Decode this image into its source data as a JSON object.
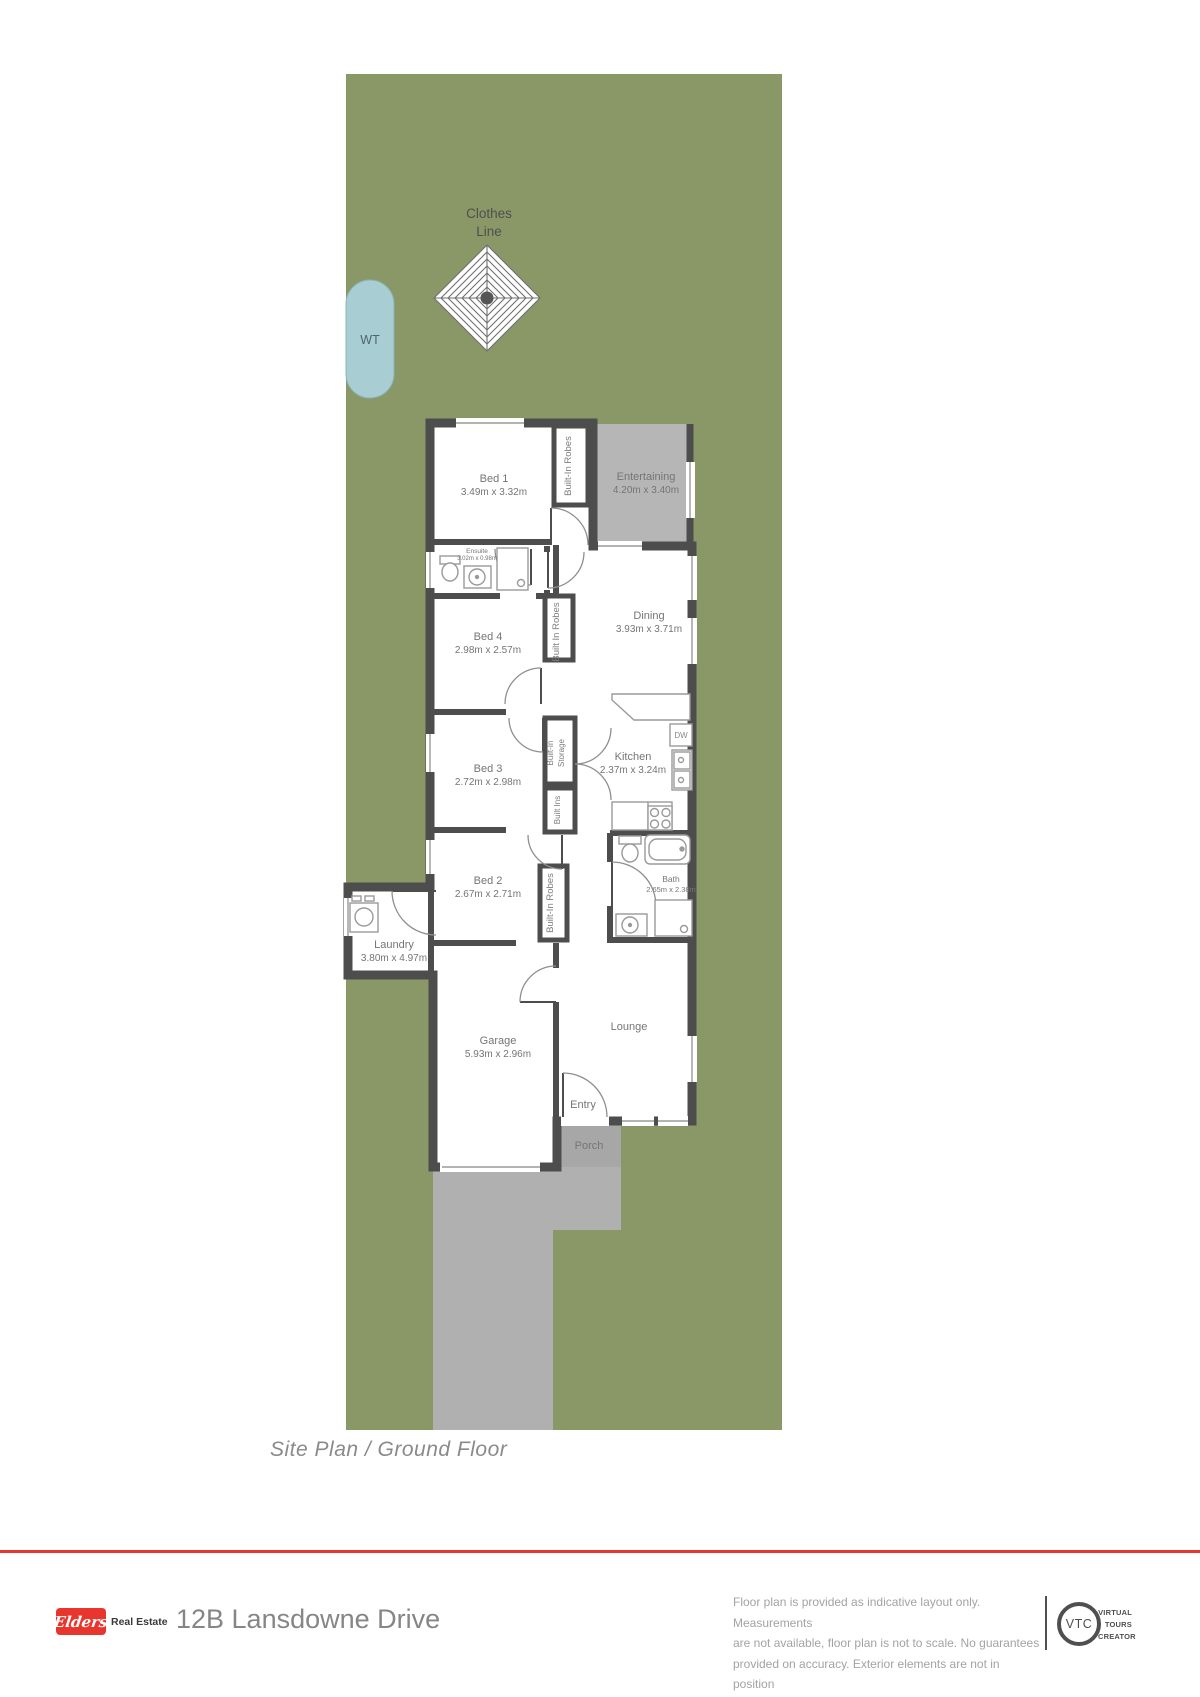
{
  "site": {
    "clothes_line_1": "Clothes",
    "clothes_line_2": "Line",
    "water_tank": "WT"
  },
  "rooms": {
    "bed1": {
      "name": "Bed 1",
      "dims": "3.49m x 3.32m"
    },
    "entertaining": {
      "name": "Entertaining",
      "dims": "4.20m x 3.40m"
    },
    "ensuite": {
      "name": "Ensuite",
      "dims": "3.02m x 0.98m"
    },
    "bed4": {
      "name": "Bed 4",
      "dims": "2.98m x 2.57m"
    },
    "dining": {
      "name": "Dining",
      "dims": "3.93m x 3.71m"
    },
    "kitchen": {
      "name": "Kitchen",
      "dims": "2.37m x 3.24m"
    },
    "bed3": {
      "name": "Bed 3",
      "dims": "2.72m x 2.98m"
    },
    "bath": {
      "name": "Bath",
      "dims": "2.65m x 2.38m"
    },
    "bed2": {
      "name": "Bed 2",
      "dims": "2.67m x 2.71m"
    },
    "laundry": {
      "name": "Laundry",
      "dims": "3.80m x 4.97m"
    },
    "garage": {
      "name": "Garage",
      "dims": "5.93m x 2.96m"
    },
    "lounge": {
      "name": "Lounge"
    },
    "entry": {
      "name": "Entry"
    },
    "porch": {
      "name": "Porch"
    }
  },
  "closets": {
    "bed1": "Built-In Robes",
    "bed4": "Built In Robes",
    "storage_top": "Built-In",
    "storage_bottom": "Storage",
    "built_ins": "Built Ins",
    "bed2": "Built-In Robes"
  },
  "appliances": {
    "dishwasher": "DW"
  },
  "caption": "Site Plan / Ground Floor",
  "footer": {
    "brand": {
      "logo_text": "Elders",
      "suffix": "Real Estate"
    },
    "address": "12B Lansdowne Drive",
    "disclaimer_line1": "Floor plan is provided as indicative layout only. Measurements",
    "disclaimer_line2": "are not available, floor plan is not to scale. No guarantees",
    "disclaimer_line3": "provided on accuracy. Exterior elements are not in position",
    "vtc": {
      "abbr": "VTC",
      "line1": "VIRTUAL",
      "line2": "TOURS",
      "line3": "CREATOR"
    }
  },
  "colors": {
    "lot_green": "#8a9868",
    "wall": "#4d4d4d",
    "entertaining_gray": "#b6b6b6",
    "porch_gray": "#a7a7a7",
    "driveway_gray": "#b0b0b0",
    "water_tank_fill": "#a8cdd2",
    "brand_red": "#e8362e"
  }
}
